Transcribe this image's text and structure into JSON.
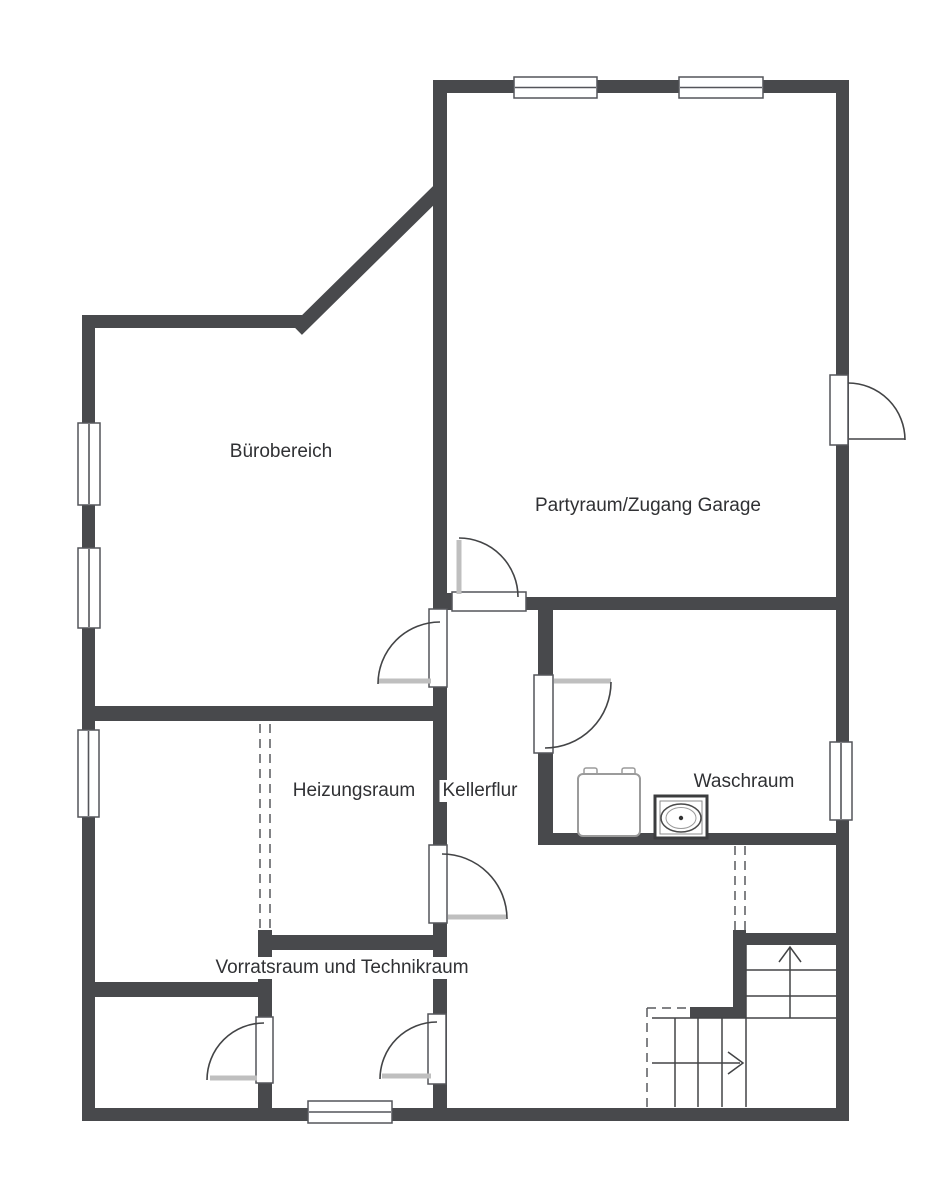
{
  "rooms": {
    "buerobereich": "Bürobereich",
    "partyraum": "Partyraum/Zugang Garage",
    "heizungsraum": "Heizungsraum",
    "kellerflur": "Kellerflur",
    "waschraum": "Waschraum",
    "vorratsraum": "Vorratsraum und Technikraum"
  },
  "colors": {
    "background": "#ffffff",
    "wall": "#48494c",
    "window_door_outline": "#54555a",
    "stair_lines": "#434446",
    "door_leaf": "#bfbfbf",
    "dashed_opening": "#595a5e",
    "label_text": "#303134",
    "appliance_outline": "#9b9b9b"
  },
  "symbols": {
    "windows_count": 7,
    "doors_count": 7,
    "staircase": "l-shaped-with-direction-arrows",
    "appliances": [
      "boiler",
      "washing-machine"
    ],
    "dashed_openings_count": 2
  }
}
